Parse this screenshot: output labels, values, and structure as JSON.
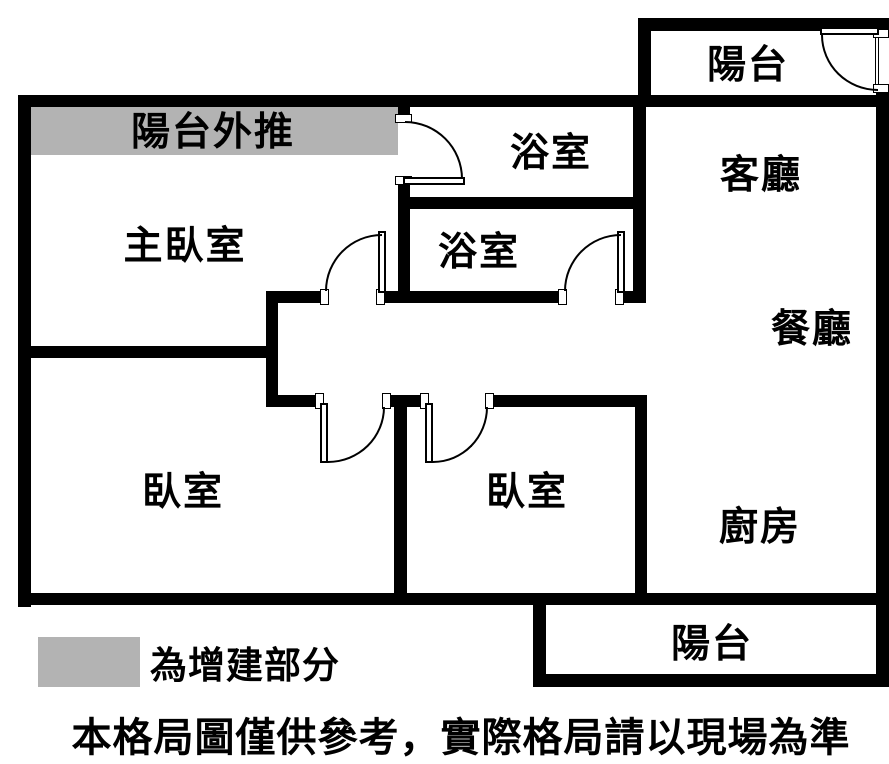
{
  "plan": {
    "rooms": {
      "balcony_top": {
        "label": "陽台"
      },
      "extension": {
        "label": "陽台外推"
      },
      "bathroom_upper": {
        "label": "浴室"
      },
      "living_room": {
        "label": "客廳"
      },
      "master_bedroom": {
        "label": "主臥室"
      },
      "bathroom_lower": {
        "label": "浴室"
      },
      "dining_room": {
        "label": "餐廳"
      },
      "bedroom_left": {
        "label": "臥室"
      },
      "bedroom_middle": {
        "label": "臥室"
      },
      "kitchen": {
        "label": "廚房"
      },
      "balcony_bottom": {
        "label": "陽台"
      }
    },
    "legend": {
      "label": "為增建部分"
    },
    "disclaimer": "本格局圖僅供參考，實際格局請以現場為準",
    "colors": {
      "wall": "#000000",
      "extension_fill": "#b3b3b3",
      "background": "#ffffff",
      "door_line": "#000000"
    }
  }
}
